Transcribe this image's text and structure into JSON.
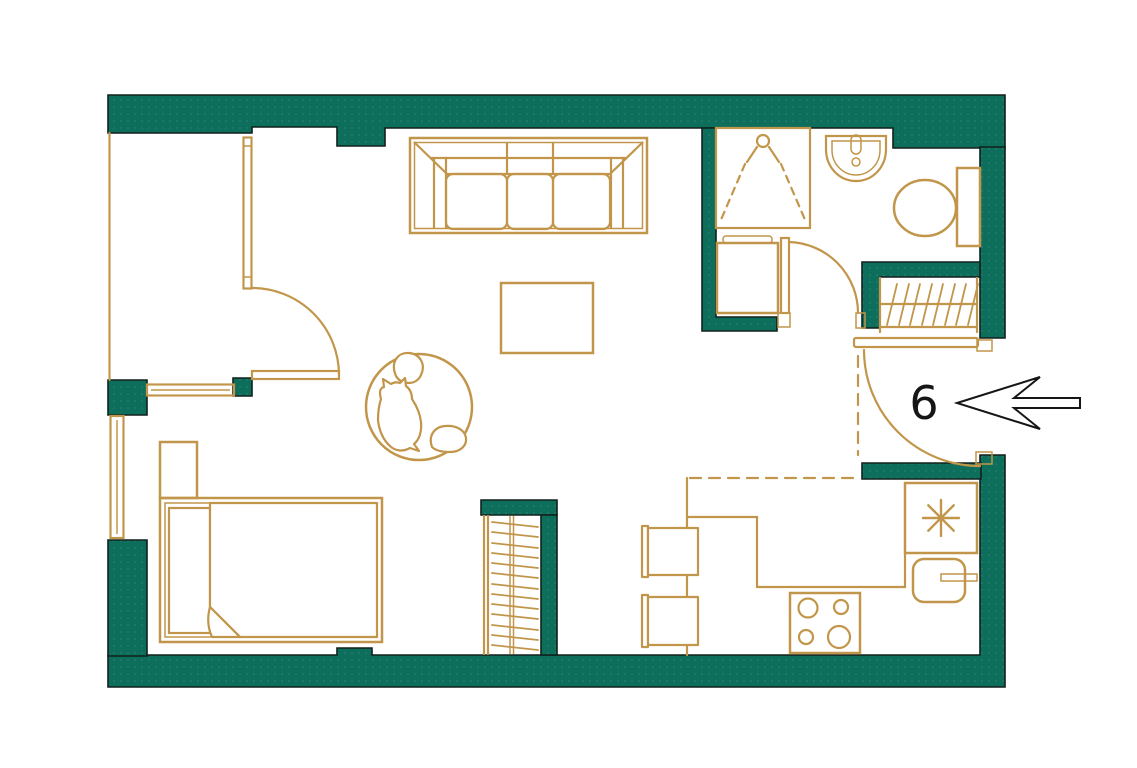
{
  "floor_plan": {
    "unit_label": "6",
    "entrance": {
      "arrow_direction": "left"
    },
    "colors": {
      "wall": "#0d6e5c",
      "wall_outline": "#12201d",
      "fixture": "#c2964a",
      "annotation": "#161616",
      "background": "#ffffff"
    },
    "elements": {
      "living": [
        "sofa",
        "coffee-table",
        "round-rug",
        "cat"
      ],
      "sleeping": [
        "double-bed",
        "pillow",
        "folded-duvet",
        "nightstand",
        "wardrobe-with-hangers",
        "window-vertical",
        "window-horizontal",
        "balcony-door"
      ],
      "bathroom": [
        "shower",
        "washbasin",
        "toilet",
        "washing-machine",
        "bathroom-door"
      ],
      "kitchen": [
        "upper-cabinets-dashed",
        "dining-table",
        "chair",
        "chair",
        "counter",
        "stove-4-burners",
        "kitchen-sink",
        "fridge-snowflake"
      ],
      "hallway": [
        "coat-rack-hatched",
        "entrance-door",
        "entrance-arrow",
        "unit-number"
      ]
    }
  }
}
